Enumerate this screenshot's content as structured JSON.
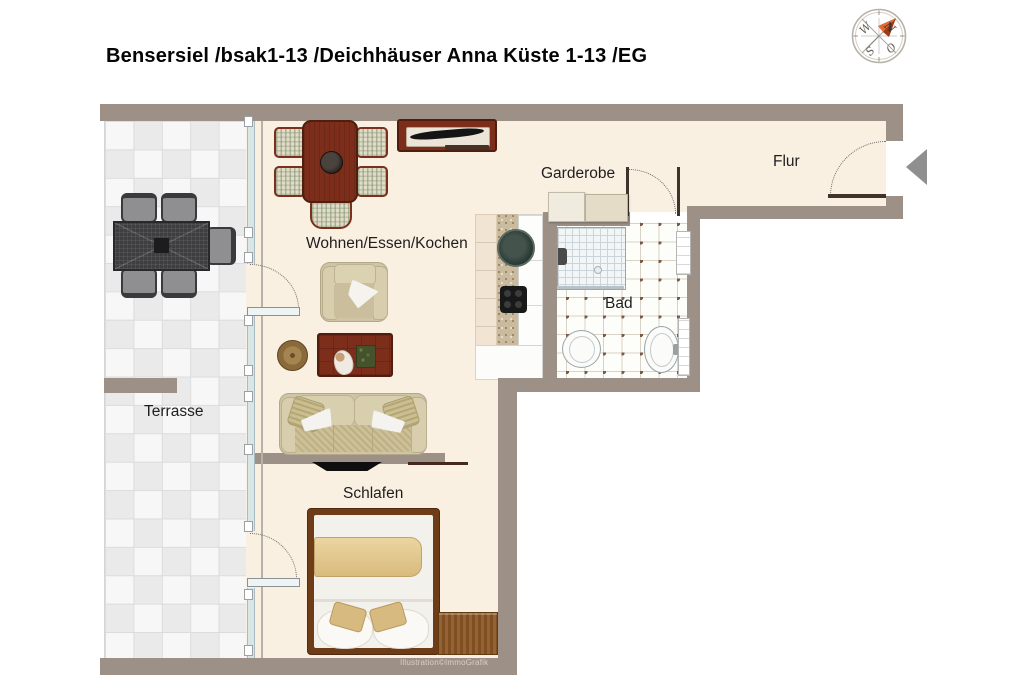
{
  "title": "Bensersiel /bsak1-13 /Deichhäuser Anna Küste 1-13 /EG",
  "rooms": {
    "living": "Wohnen/Essen/Kochen",
    "wardrobe": "Garderobe",
    "hallway": "Flur",
    "bathroom": "Bad",
    "terrace": "Terrasse",
    "bedroom": "Schlafen"
  },
  "compass": {
    "north": "N",
    "east": "O",
    "south": "S",
    "west": "W"
  },
  "watermark": "Illustration©ImmoGrafik",
  "entry_arrow_direction": "left",
  "colors": {
    "wall": "#9c9087",
    "floor": "#faf0e1",
    "wood_accent": "#7c2e1b",
    "compass_needle": "#d2592c",
    "entry_arrow": "#8f8f8f"
  }
}
